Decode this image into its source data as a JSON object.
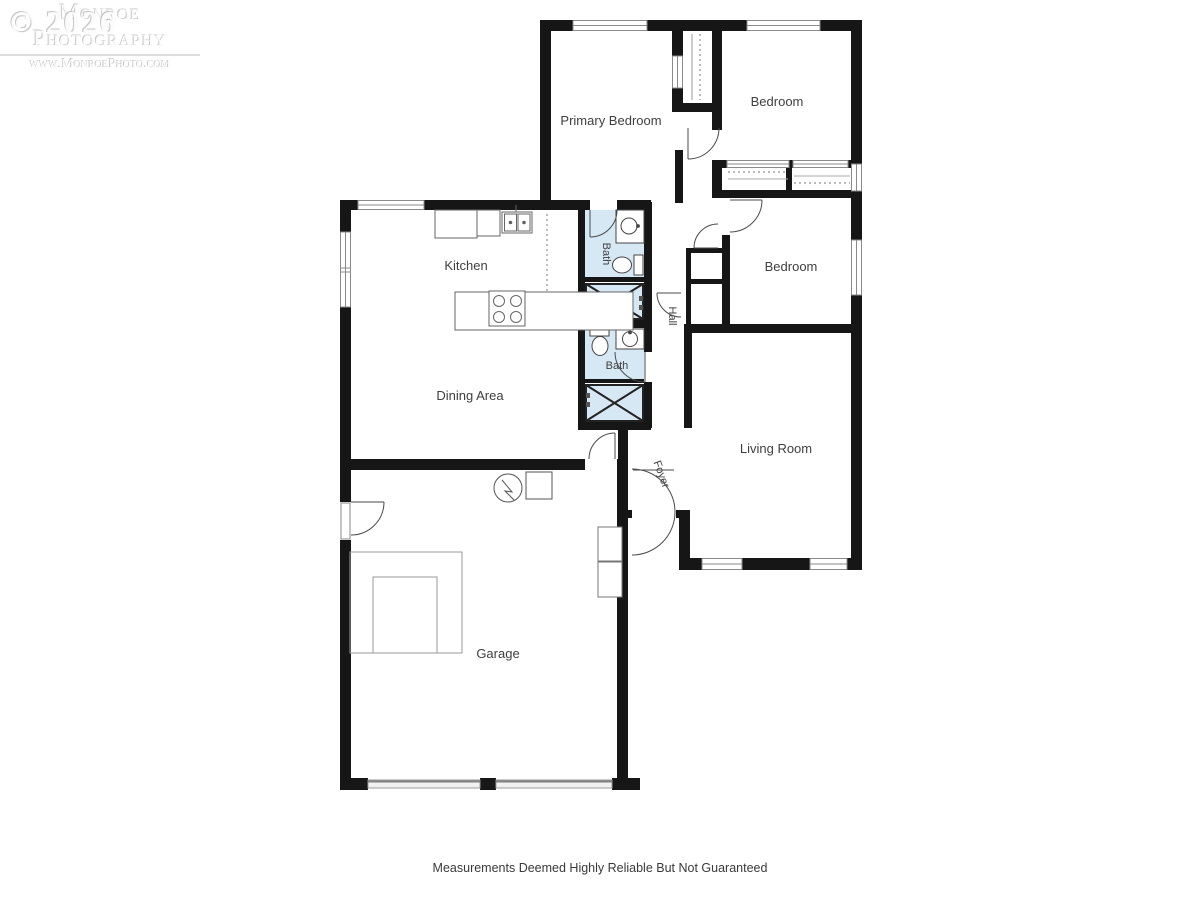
{
  "watermark": {
    "copyright": "© 2026",
    "studio": "Monroe Photography",
    "website": "www.MonroePhoto.com"
  },
  "disclaimer": "Measurements Deemed Highly Reliable But Not Guaranteed",
  "rooms": {
    "primary_bedroom": "Primary Bedroom",
    "bedroom_top": "Bedroom",
    "bedroom_middle": "Bedroom",
    "kitchen": "Kitchen",
    "dining": "Dining Area",
    "living": "Living Room",
    "garage": "Garage",
    "bath_upper": "Bath",
    "bath_lower": "Bath",
    "hall": "Hall",
    "foyer": "Foyer"
  },
  "colors": {
    "wall": "#161616",
    "bath_fill": "#d7e8f5",
    "label": "#3f3f3f",
    "watermark": "#dcdcdc"
  }
}
